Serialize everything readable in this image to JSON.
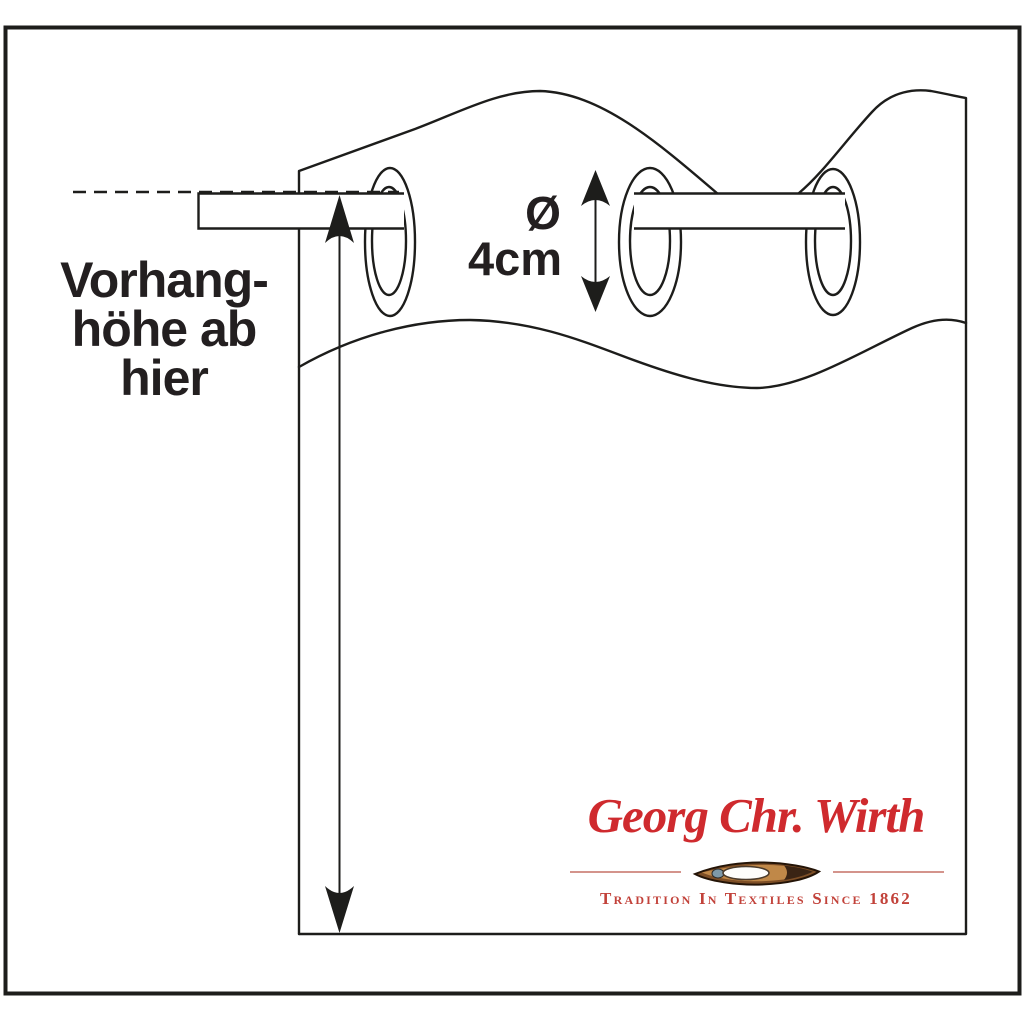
{
  "colors": {
    "line": "#1d1d1b",
    "label_text": "#231f20",
    "brand_red": "#cf2a2e",
    "tagline_red": "#c2423a",
    "divider_red": "#d4948c",
    "background": "#ffffff"
  },
  "diagram": {
    "height_label": {
      "lines": [
        "Vorhang-",
        "höhe ab",
        "hier"
      ]
    },
    "diameter_label": {
      "symbol": "Ø",
      "value": "4cm"
    }
  },
  "logo": {
    "brand": "Georg Chr. Wirth",
    "tagline": "Tradition In Textiles Since 1862",
    "emblem_icon": "weaving-shuttle-icon"
  }
}
